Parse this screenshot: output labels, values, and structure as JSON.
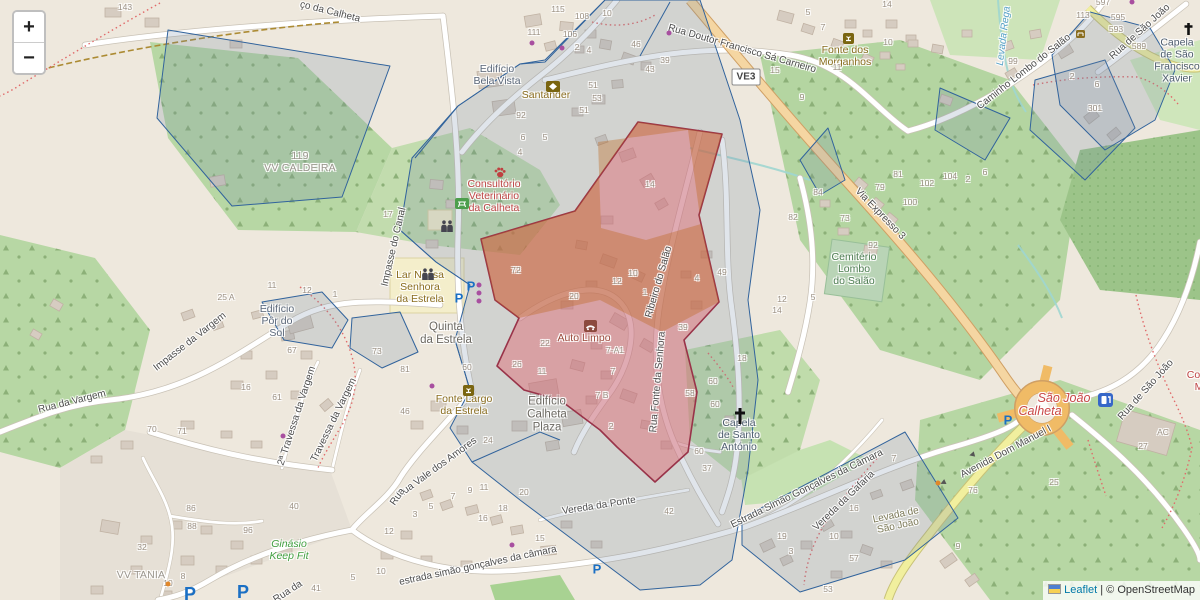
{
  "controls": {
    "zoom_in_label": "+",
    "zoom_out_label": "−"
  },
  "attribution": {
    "leaflet_link": "Leaflet",
    "separator": "|",
    "osm_credit": "© OpenStreetMap"
  },
  "road_shield": {
    "label": "VE3"
  },
  "colors": {
    "overlay_blue_stroke": "#31639c",
    "overlay_blue_fill": "rgba(115,135,165,0.22)",
    "overlay_red_stroke": "#993349",
    "overlay_red_fill": "rgba(225,100,110,0.45)",
    "overlay_tan_fill": "rgba(190,105,35,0.38)",
    "forest_green": "#b7d7a4",
    "residential": "#e3ddd4",
    "trunk_road": "#f5d6a2",
    "secondary_road": "#f1ef9e"
  },
  "map": {
    "street_labels": [
      {
        "text": "ço da Calheta",
        "x": 330,
        "y": 12,
        "rot": 14
      },
      {
        "text": "Rua Doutor Francisco Sá Carneiro",
        "x": 742,
        "y": 49,
        "rot": 16
      },
      {
        "text": "Caminho Lombo do Salão",
        "x": 1024,
        "y": 72,
        "rot": -38
      },
      {
        "text": "Rua de São João",
        "x": 1140,
        "y": 32,
        "rot": -42
      },
      {
        "text": "Levada Rega",
        "x": 1004,
        "y": 36,
        "rot": -83,
        "cls": "water"
      },
      {
        "text": "Via Expresso 3",
        "x": 880,
        "y": 214,
        "rot": 46
      },
      {
        "text": "Impasse do Canal",
        "x": 394,
        "y": 247,
        "rot": -77
      },
      {
        "text": "Impasse da Vargem",
        "x": 190,
        "y": 342,
        "rot": -38
      },
      {
        "text": "Rua da Vargem",
        "x": 72,
        "y": 402,
        "rot": -14
      },
      {
        "text": "2ª Travessa da Vargem",
        "x": 297,
        "y": 416,
        "rot": -72
      },
      {
        "text": "Travessa da Vargem",
        "x": 334,
        "y": 420,
        "rot": -64
      },
      {
        "text": "Rua Vale dos Amores",
        "x": 437,
        "y": 468,
        "rot": -36
      },
      {
        "text": "Ribeiro do Salão",
        "x": 659,
        "y": 282,
        "rot": -74
      },
      {
        "text": "Rua Fonte da Senhora",
        "x": 658,
        "y": 382,
        "rot": -85
      },
      {
        "text": "Vereda da Ponte",
        "x": 599,
        "y": 506,
        "rot": -9
      },
      {
        "text": "estrada simão gonçalves da câmara",
        "x": 478,
        "y": 566,
        "rot": -12
      },
      {
        "text": "Estrada Simão Gonçalves da Câmara",
        "x": 807,
        "y": 489,
        "rot": -26
      },
      {
        "text": "Vereda da Gafaria",
        "x": 844,
        "y": 501,
        "rot": -44
      },
      {
        "text": "Avenida Dom Manuel I",
        "x": 1006,
        "y": 452,
        "rot": -28
      },
      {
        "text": "Rua de São João",
        "x": 1146,
        "y": 390,
        "rot": -48
      },
      {
        "text": "Rua",
        "x": 398,
        "y": 497,
        "rot": -55
      },
      {
        "text": "Rua da",
        "x": 288,
        "y": 592,
        "rot": -33
      },
      {
        "text": "Levada de\nSão João",
        "x": 897,
        "y": 521,
        "rot": -12,
        "cls": "levada"
      }
    ],
    "place_labels": [
      {
        "text": "Edifício\nBela Vista",
        "x": 497,
        "y": 76,
        "cls": "building"
      },
      {
        "text": "Santander",
        "x": 546,
        "y": 96,
        "cls": "brown"
      },
      {
        "text": "119\nVV CALDEIRA",
        "x": 300,
        "y": 163,
        "cls": "gray"
      },
      {
        "text": "Consultório\nVeterinário\nda Calheta",
        "x": 494,
        "y": 197,
        "cls": "red"
      },
      {
        "text": "Lar Nossa\nSenhora\nda Estrela",
        "x": 420,
        "y": 288,
        "cls": "brown"
      },
      {
        "text": "Quinta\nda Estrela",
        "x": 446,
        "y": 334,
        "cls": "dark"
      },
      {
        "text": "Edifício\nPôr do\nSol",
        "x": 277,
        "y": 322,
        "cls": "building"
      },
      {
        "text": "Auto Limpo",
        "x": 584,
        "y": 339,
        "cls": "maroon"
      },
      {
        "text": "Fonte Largo\nda Estrela",
        "x": 464,
        "y": 406,
        "cls": "brown"
      },
      {
        "text": "Edifício\nCalheta\nPlaza",
        "x": 547,
        "y": 415,
        "cls": "dark"
      },
      {
        "text": "Capela\nde Santo\nAntónio",
        "x": 739,
        "y": 436,
        "cls": "slate"
      },
      {
        "text": "Cemitério\nLombo\ndo Salão",
        "x": 854,
        "y": 270,
        "cls": "green-dark"
      },
      {
        "text": "Fonte dos\nMorganhos",
        "x": 845,
        "y": 57,
        "cls": "brown"
      },
      {
        "text": "Capela\nde São\nFrancisco\nXavier",
        "x": 1177,
        "y": 61,
        "cls": "slate"
      },
      {
        "text": "Ginásio\nKeep Fit",
        "x": 289,
        "y": 551,
        "cls": "green-italic"
      },
      {
        "text": "VV TANIA",
        "x": 141,
        "y": 576,
        "cls": "gray"
      },
      {
        "text": "São João",
        "x": 1064,
        "y": 398,
        "cls": "town"
      },
      {
        "text": "Calheta",
        "x": 1040,
        "y": 411,
        "cls": "town"
      },
      {
        "text": "Cons\nM",
        "x": 1199,
        "y": 382,
        "cls": "red"
      }
    ],
    "house_numbers": [
      [
        "143",
        125,
        8
      ],
      [
        "115",
        558,
        10
      ],
      [
        "108",
        582,
        17
      ],
      [
        "10",
        607,
        14
      ],
      [
        "111",
        534,
        33
      ],
      [
        "106",
        570,
        35
      ],
      [
        "2",
        577,
        48
      ],
      [
        "4",
        589,
        51
      ],
      [
        "46",
        636,
        45
      ],
      [
        "39",
        665,
        61
      ],
      [
        "43",
        650,
        70
      ],
      [
        "51",
        593,
        86
      ],
      [
        "53",
        597,
        99
      ],
      [
        "51",
        584,
        111
      ],
      [
        "92",
        521,
        116
      ],
      [
        "5",
        808,
        13
      ],
      [
        "14",
        887,
        5
      ],
      [
        "7",
        823,
        28
      ],
      [
        "10",
        888,
        43
      ],
      [
        "11",
        837,
        68
      ],
      [
        "15",
        775,
        71
      ],
      [
        "9",
        802,
        98
      ],
      [
        "113",
        1083,
        16
      ],
      [
        "597",
        1103,
        3
      ],
      [
        "595",
        1118,
        18
      ],
      [
        "593",
        1116,
        30
      ],
      [
        "589",
        1139,
        47
      ],
      [
        "99",
        1013,
        62
      ],
      [
        "2",
        1072,
        77
      ],
      [
        "6",
        1097,
        85
      ],
      [
        "301",
        1095,
        109
      ],
      [
        "84",
        818,
        193
      ],
      [
        "81",
        898,
        175
      ],
      [
        "79",
        880,
        188
      ],
      [
        "82",
        793,
        218
      ],
      [
        "73",
        845,
        219
      ],
      [
        "100",
        910,
        203
      ],
      [
        "102",
        927,
        184
      ],
      [
        "104",
        950,
        177
      ],
      [
        "2",
        968,
        180
      ],
      [
        "6",
        985,
        173
      ],
      [
        "92",
        873,
        246
      ],
      [
        "5",
        813,
        298
      ],
      [
        "6",
        523,
        138
      ],
      [
        "4",
        520,
        153
      ],
      [
        "5",
        545,
        138
      ],
      [
        "17",
        388,
        215
      ],
      [
        "72",
        516,
        271
      ],
      [
        "20",
        574,
        297
      ],
      [
        "12",
        617,
        282
      ],
      [
        "10",
        633,
        274
      ],
      [
        "1",
        645,
        293
      ],
      [
        "4",
        697,
        279
      ],
      [
        "49",
        722,
        273
      ],
      [
        "39",
        683,
        328
      ],
      [
        "12",
        782,
        300
      ],
      [
        "14",
        777,
        311
      ],
      [
        "18",
        742,
        359
      ],
      [
        "60",
        713,
        382
      ],
      [
        "58",
        690,
        394
      ],
      [
        "60",
        715,
        405
      ],
      [
        "7-A1",
        615,
        351
      ],
      [
        "7",
        613,
        372
      ],
      [
        "7 B",
        602,
        396
      ],
      [
        "14",
        650,
        185
      ],
      [
        "22",
        545,
        344
      ],
      [
        "26",
        517,
        365
      ],
      [
        "11",
        542,
        372
      ],
      [
        "60",
        467,
        368
      ],
      [
        "73",
        377,
        352
      ],
      [
        "81",
        405,
        370
      ],
      [
        "25 A",
        226,
        298
      ],
      [
        "11",
        272,
        286
      ],
      [
        "12",
        307,
        291
      ],
      [
        "1",
        335,
        295
      ],
      [
        "67",
        292,
        351
      ],
      [
        "16",
        246,
        388
      ],
      [
        "61",
        277,
        398
      ],
      [
        "70",
        152,
        430
      ],
      [
        "71",
        182,
        432
      ],
      [
        "46",
        405,
        412
      ],
      [
        "24",
        488,
        441
      ],
      [
        "2",
        611,
        427
      ],
      [
        "37",
        707,
        469
      ],
      [
        "42",
        669,
        512
      ],
      [
        "60",
        699,
        452
      ],
      [
        "7",
        453,
        497
      ],
      [
        "9",
        470,
        491
      ],
      [
        "11",
        484,
        488
      ],
      [
        "20",
        524,
        493
      ],
      [
        "18",
        503,
        509
      ],
      [
        "16",
        483,
        519
      ],
      [
        "15",
        540,
        539
      ],
      [
        "3",
        415,
        515
      ],
      [
        "5",
        431,
        507
      ],
      [
        "12",
        389,
        532
      ],
      [
        "10",
        381,
        572
      ],
      [
        "5",
        353,
        578
      ],
      [
        "86",
        191,
        509
      ],
      [
        "88",
        192,
        527
      ],
      [
        "96",
        248,
        531
      ],
      [
        "32",
        142,
        548
      ],
      [
        "10",
        168,
        584
      ],
      [
        "8",
        183,
        577
      ],
      [
        "40",
        294,
        507
      ],
      [
        "41",
        316,
        589
      ],
      [
        "19",
        782,
        537
      ],
      [
        "10",
        834,
        537
      ],
      [
        "16",
        854,
        509
      ],
      [
        "7",
        894,
        459
      ],
      [
        "3",
        791,
        552
      ],
      [
        "57",
        854,
        559
      ],
      [
        "53",
        828,
        590
      ],
      [
        "76",
        973,
        491
      ],
      [
        "9",
        958,
        547
      ],
      [
        "27",
        1143,
        447
      ],
      [
        "AC",
        1163,
        433
      ],
      [
        "25",
        1054,
        483
      ]
    ],
    "icons": [
      [
        "bank",
        546,
        81
      ],
      [
        "paw",
        494,
        167
      ],
      [
        "picnic",
        455,
        198
      ],
      [
        "school",
        440,
        220
      ],
      [
        "school",
        421,
        268
      ],
      [
        "parking",
        459,
        298
      ],
      [
        "parking",
        471,
        286
      ],
      [
        "parking",
        1008,
        420
      ],
      [
        "parking",
        597,
        569
      ],
      [
        "parking-big",
        190,
        594
      ],
      [
        "parking-big",
        243,
        592
      ],
      [
        "carwash",
        584,
        320
      ],
      [
        "fountain",
        463,
        385
      ],
      [
        "fountain",
        843,
        33
      ],
      [
        "bench",
        1076,
        30
      ],
      [
        "cross",
        733,
        407
      ],
      [
        "cross-sm",
        1183,
        22
      ],
      [
        "fuel",
        1098,
        393
      ],
      [
        "dot",
        532,
        43
      ],
      [
        "dot",
        562,
        48
      ],
      [
        "dot",
        669,
        33
      ],
      [
        "dot",
        479,
        285
      ],
      [
        "dot",
        479,
        293
      ],
      [
        "dot",
        479,
        301
      ],
      [
        "dot",
        283,
        436
      ],
      [
        "dot",
        432,
        386
      ],
      [
        "dot",
        1132,
        2
      ],
      [
        "dot",
        512,
        545
      ],
      [
        "odot",
        938,
        483
      ],
      [
        "odot",
        168,
        584
      ],
      [
        "arrow",
        972,
        455,
        -15
      ],
      [
        "arrow",
        943,
        483,
        -25
      ]
    ]
  }
}
